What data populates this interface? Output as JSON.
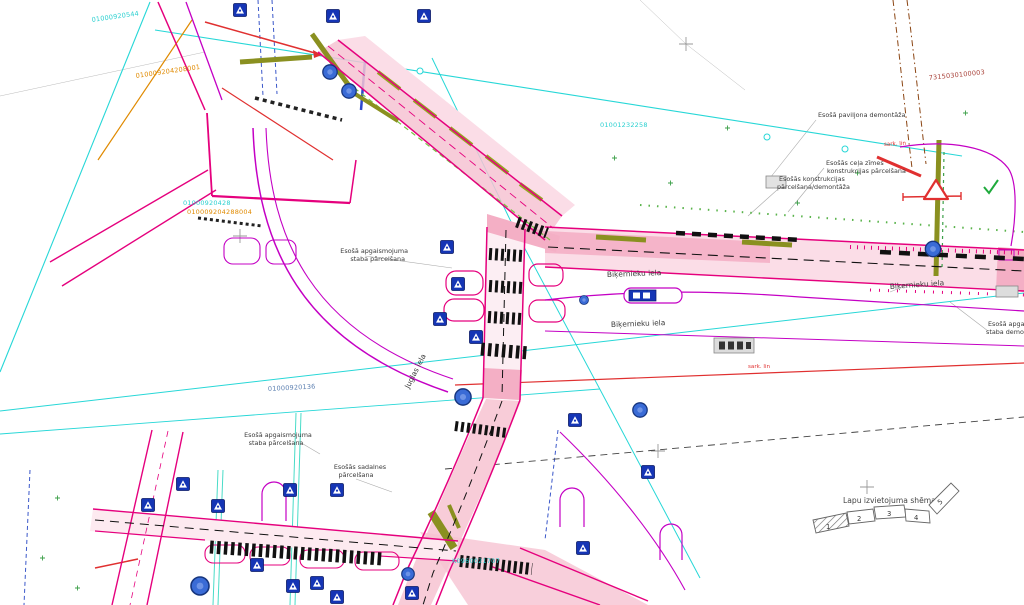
{
  "document": {
    "type": "road-reconstruction-site-plan",
    "language": "Latvian"
  },
  "palette": {
    "cadastral_cyan": "#2bd0d0",
    "cadastral_orange": "#e08a00",
    "cadastral_blue": "#5b7fb0",
    "parcel_brown": "#a84038",
    "road_edge_crimson": "#e5007d",
    "road_edge_magenta": "#c400c4",
    "road_fill_pink": "#f6c3d2",
    "utility_cyan": "#27d7d7",
    "red_line": "#e03030",
    "olive": "#8a9020",
    "sign_blue": "#1535b5",
    "manhole_blue": "#3a6bd6"
  },
  "icons": {
    "traffic_sign": "pedestrian-crossing-sign",
    "manhole": "utility-manhole",
    "warning": "warning-triangle-sign",
    "bus_shelter": "bus-shelter",
    "survey_cross": "coordinate-grid-cross"
  },
  "texts": {
    "cadastral": [
      {
        "text": "01000920544"
      },
      {
        "text": "010009204208001"
      },
      {
        "text": "01000920428"
      },
      {
        "text": "010009204288004"
      },
      {
        "text": "01000920136"
      },
      {
        "text": "01001232258"
      },
      {
        "text": "7315030100003"
      },
      {
        "text": "K0960021707"
      }
    ],
    "callouts": {
      "pavilion_demolition": {
        "line1": "Esošā paviljona demontāža"
      },
      "road_sign_relocation": {
        "line1": "Esošās ceļa zīmes",
        "line2": "konstrukcijas pārcelšana"
      },
      "structure_relocation": {
        "line1": "Esošās konstrukcijas",
        "line2": "pārcelšana/demontāža"
      },
      "lighting_pole_relocation_1": {
        "line1": "Esošā apgaismojuma",
        "line2": "staba pārcelšana"
      },
      "lighting_pole_relocation_2": {
        "line1": "Esošā apgaismojuma",
        "line2": "staba pārcelšana"
      },
      "switchboard_relocation": {
        "line1": "Esošās sadalnes",
        "line2": "pārcelšana"
      },
      "lighting_pole_demolition": {
        "line1": "Esošā apgaismojuma",
        "line2": "staba demontāža"
      }
    },
    "streets": {
      "bikernieku": "Biķernieku iela",
      "juglas": "Juglas iela"
    },
    "red_line_abbr": "sark. lin",
    "scheme": {
      "title": "Lapu izvietojuma shēma",
      "sheet_numbers": [
        "1",
        "2",
        "3",
        "4",
        "5"
      ]
    }
  }
}
